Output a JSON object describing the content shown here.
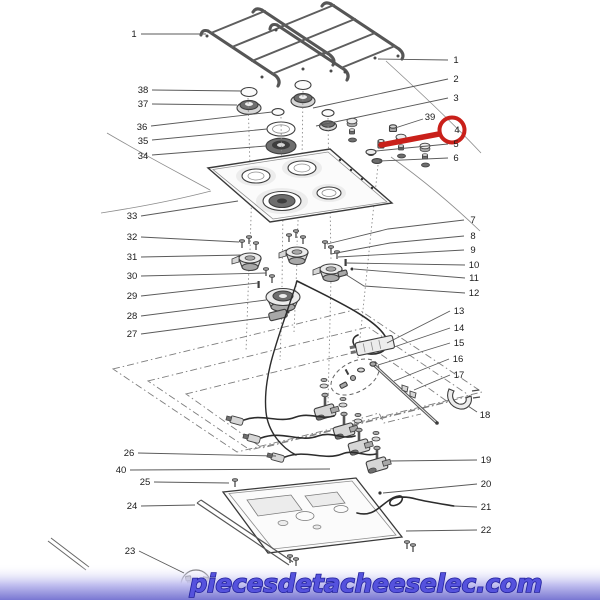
{
  "watermark": {
    "text": "piecesdetacheeselec.com",
    "text_color": "#5552dd",
    "outline_color": "#22219b",
    "band_gradient": [
      "rgba(255,255,255,0)",
      "#c6c4f1",
      "#7977d2"
    ]
  },
  "highlight": {
    "part": "4",
    "color": "#c9201a",
    "circle": [
      452,
      130,
      12.5
    ],
    "pointer": [
      [
        439,
        134
      ],
      [
        381,
        145
      ]
    ]
  },
  "diagram": {
    "title": "Exploded parts diagram of a 4-burner gas hob",
    "callouts": [
      {
        "num": "1",
        "label": [
          134,
          34
        ],
        "line": [
          [
            141,
            34
          ],
          [
            206,
            34
          ]
        ]
      },
      {
        "num": "38",
        "label": [
          143,
          90
        ],
        "line": [
          [
            152,
            90
          ],
          [
            242,
            91
          ]
        ]
      },
      {
        "num": "37",
        "label": [
          143,
          104
        ],
        "line": [
          [
            152,
            104
          ],
          [
            237,
            105
          ]
        ]
      },
      {
        "num": "36",
        "label": [
          142,
          127
        ],
        "line": [
          [
            151,
            126
          ],
          [
            272,
            112
          ]
        ]
      },
      {
        "num": "35",
        "label": [
          143,
          141
        ],
        "line": [
          [
            152,
            140
          ],
          [
            267,
            129
          ]
        ]
      },
      {
        "num": "34",
        "label": [
          143,
          156
        ],
        "line": [
          [
            152,
            155
          ],
          [
            266,
            146
          ]
        ]
      },
      {
        "num": "33",
        "label": [
          132,
          216
        ],
        "line": [
          [
            141,
            216
          ],
          [
            238,
            201
          ]
        ]
      },
      {
        "num": "32",
        "label": [
          132,
          237
        ],
        "line": [
          [
            141,
            237
          ],
          [
            239,
            242
          ]
        ]
      },
      {
        "num": "31",
        "label": [
          132,
          257
        ],
        "line": [
          [
            141,
            257
          ],
          [
            242,
            255
          ]
        ]
      },
      {
        "num": "30",
        "label": [
          132,
          276
        ],
        "line": [
          [
            141,
            276
          ],
          [
            266,
            273
          ]
        ]
      },
      {
        "num": "29",
        "label": [
          132,
          296
        ],
        "line": [
          [
            141,
            296
          ],
          [
            258,
            283
          ]
        ]
      },
      {
        "num": "28",
        "label": [
          132,
          316
        ],
        "line": [
          [
            141,
            316
          ],
          [
            266,
            300
          ]
        ]
      },
      {
        "num": "27",
        "label": [
          132,
          334
        ],
        "line": [
          [
            141,
            334
          ],
          [
            269,
            317
          ]
        ]
      },
      {
        "num": "26",
        "label": [
          129,
          453
        ],
        "line": [
          [
            138,
            453
          ],
          [
            276,
            456
          ]
        ]
      },
      {
        "num": "40",
        "label": [
          121,
          470
        ],
        "line": [
          [
            130,
            470
          ],
          [
            330,
            469
          ]
        ]
      },
      {
        "num": "25",
        "label": [
          145,
          482
        ],
        "line": [
          [
            154,
            482
          ],
          [
            229,
            483
          ]
        ]
      },
      {
        "num": "24",
        "label": [
          132,
          506
        ],
        "line": [
          [
            141,
            506
          ],
          [
            195,
            505
          ]
        ]
      },
      {
        "num": "23",
        "label": [
          130,
          551
        ],
        "line": [
          [
            139,
            551
          ],
          [
            184,
            573
          ]
        ]
      },
      {
        "num": "1",
        "label": [
          456,
          60
        ],
        "line": [
          [
            448,
            60
          ],
          [
            378,
            59
          ]
        ]
      },
      {
        "num": "2",
        "label": [
          456,
          79
        ],
        "line": [
          [
            448,
            79
          ],
          [
            313,
            108
          ]
        ]
      },
      {
        "num": "3",
        "label": [
          456,
          98
        ],
        "line": [
          [
            448,
            98
          ],
          [
            316,
            126
          ]
        ]
      },
      {
        "num": "39",
        "label": [
          430,
          117
        ],
        "line": [
          [
            423,
            119
          ],
          [
            395,
            128
          ]
        ]
      },
      {
        "num": "4",
        "label": [
          457,
          130
        ],
        "line": []
      },
      {
        "num": "5",
        "label": [
          456,
          144
        ],
        "line": [
          [
            448,
            144
          ],
          [
            376,
            151
          ]
        ]
      },
      {
        "num": "6",
        "label": [
          456,
          158
        ],
        "line": [
          [
            448,
            158
          ],
          [
            379,
            161
          ]
        ]
      },
      {
        "num": "7",
        "label": [
          473,
          220
        ],
        "line": [
          [
            464,
            220
          ],
          [
            388,
            229
          ],
          [
            327,
            244
          ]
        ]
      },
      {
        "num": "8",
        "label": [
          473,
          236
        ],
        "line": [
          [
            464,
            236
          ],
          [
            390,
            243
          ],
          [
            331,
            254
          ]
        ]
      },
      {
        "num": "9",
        "label": [
          473,
          250
        ],
        "line": [
          [
            464,
            250
          ],
          [
            338,
            257
          ]
        ]
      },
      {
        "num": "10",
        "label": [
          474,
          265
        ],
        "line": [
          [
            465,
            265
          ],
          [
            346,
            263
          ]
        ]
      },
      {
        "num": "11",
        "label": [
          474,
          278
        ],
        "line": [
          [
            465,
            278
          ],
          [
            354,
            269
          ]
        ]
      },
      {
        "num": "12",
        "label": [
          474,
          293
        ],
        "line": [
          [
            465,
            293
          ],
          [
            364,
            286
          ],
          [
            345,
            274
          ]
        ]
      },
      {
        "num": "13",
        "label": [
          459,
          311
        ],
        "line": [
          [
            450,
            311
          ],
          [
            387,
            343
          ]
        ]
      },
      {
        "num": "14",
        "label": [
          459,
          328
        ],
        "line": [
          [
            450,
            328
          ],
          [
            394,
            347
          ]
        ]
      },
      {
        "num": "15",
        "label": [
          459,
          343
        ],
        "line": [
          [
            450,
            343
          ],
          [
            378,
            365
          ]
        ]
      },
      {
        "num": "16",
        "label": [
          458,
          359
        ],
        "line": [
          [
            449,
            359
          ],
          [
            394,
            381
          ]
        ]
      },
      {
        "num": "17",
        "label": [
          459,
          375
        ],
        "line": [
          [
            450,
            375
          ],
          [
            414,
            390
          ]
        ]
      },
      {
        "num": "18",
        "label": [
          485,
          415
        ],
        "line": [
          [
            477,
            412
          ],
          [
            468,
            406
          ]
        ]
      },
      {
        "num": "19",
        "label": [
          486,
          460
        ],
        "line": [
          [
            477,
            460
          ],
          [
            390,
            461
          ]
        ]
      },
      {
        "num": "20",
        "label": [
          486,
          484
        ],
        "line": [
          [
            477,
            484
          ],
          [
            383,
            493
          ]
        ]
      },
      {
        "num": "21",
        "label": [
          486,
          507
        ],
        "line": [
          [
            477,
            507
          ],
          [
            454,
            506
          ]
        ]
      },
      {
        "num": "22",
        "label": [
          486,
          530
        ],
        "line": [
          [
            477,
            530
          ],
          [
            406,
            531
          ]
        ]
      }
    ]
  }
}
